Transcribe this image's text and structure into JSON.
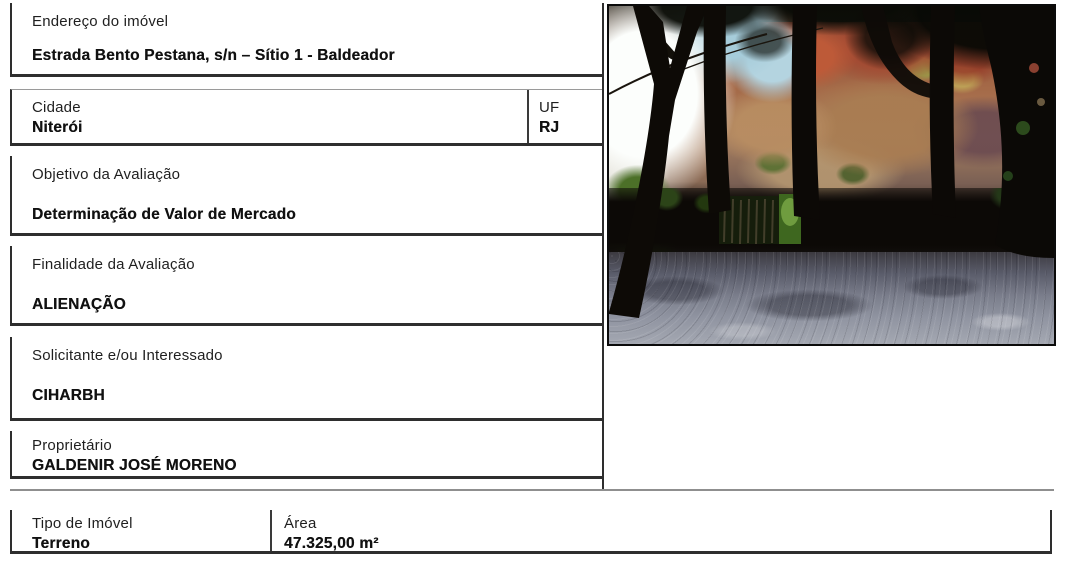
{
  "page": {
    "background": "#ffffff",
    "border_color": "#2e2e2e"
  },
  "fields": {
    "endereco": {
      "label": "Endereço do imóvel",
      "value": "Estrada Bento Pestana, s/n – Sítio 1 - Baldeador"
    },
    "cidade": {
      "label": "Cidade",
      "value": "Niterói"
    },
    "uf": {
      "label": "UF",
      "value": "RJ"
    },
    "objetivo": {
      "label": "Objetivo da Avaliação",
      "value": "Determinação de Valor de Mercado"
    },
    "finalidade": {
      "label": "Finalidade da Avaliação",
      "value": "ALIENAÇÃO"
    },
    "solicitante": {
      "label": "Solicitante e/ou Interessado",
      "value": "CIHARBH"
    },
    "proprietario": {
      "label": "Proprietário",
      "value": "GALDENIR JOSÉ MORENO"
    },
    "tipo_imovel": {
      "label": "Tipo de Imóvel",
      "value": "Terreno"
    },
    "area": {
      "label": "Área",
      "value": "47.325,00 m²"
    }
  },
  "photo": {
    "palette": {
      "sky_white": "#fcfefc",
      "sky_blue": "#a6ccda",
      "rock_tan": "#a56a48",
      "rock_red": "#a34a32",
      "foliage_dark": "#35511f",
      "foliage_bright": "#6f9c3f",
      "shadow_black": "#0c0906",
      "ground_gray": "#8f93a0",
      "trunk_black": "#0d0a06"
    }
  }
}
